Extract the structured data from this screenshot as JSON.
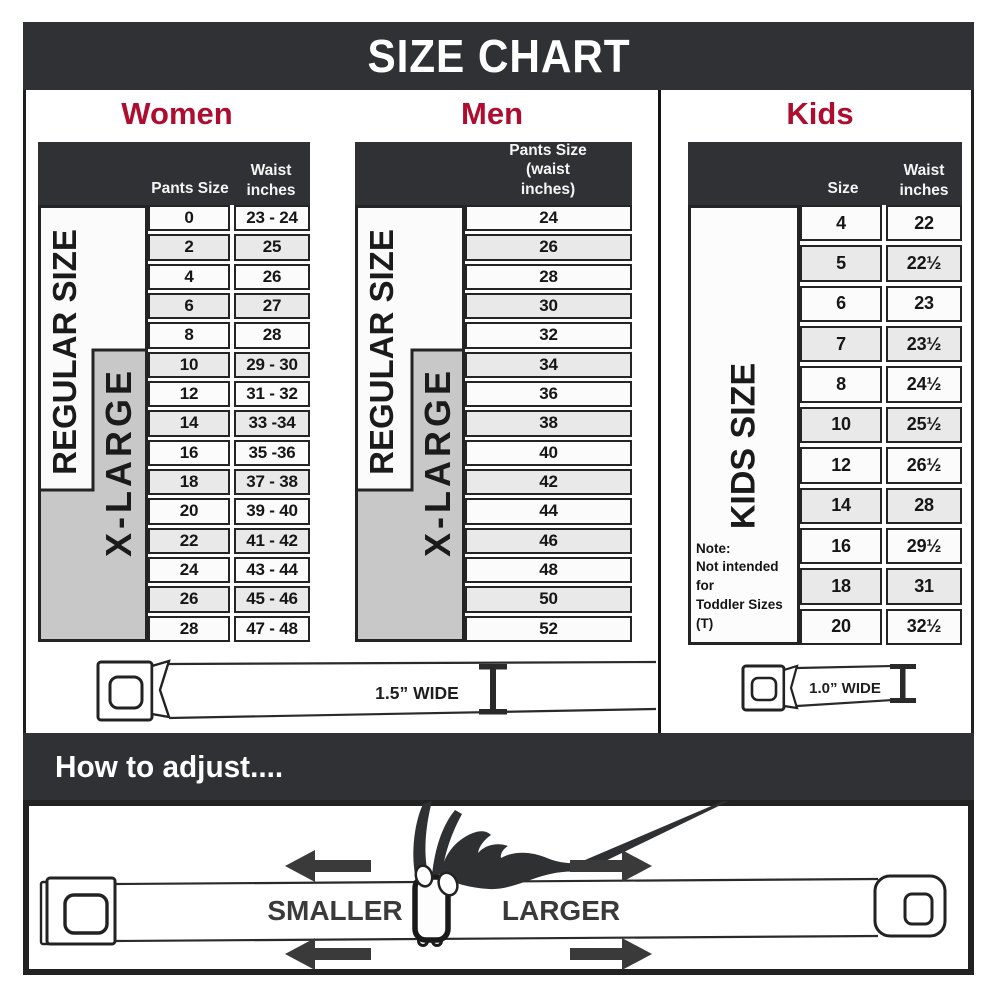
{
  "title": "SIZE CHART",
  "sections": {
    "women": {
      "label": "Women",
      "col1_header": "Pants Size",
      "col2_header": "Waist\ninches",
      "regular_label": "REGULAR SIZE",
      "xlarge_label": "X-LARGE",
      "rows": [
        [
          "0",
          "23 - 24"
        ],
        [
          "2",
          "25"
        ],
        [
          "4",
          "26"
        ],
        [
          "6",
          "27"
        ],
        [
          "8",
          "28"
        ],
        [
          "10",
          "29 - 30"
        ],
        [
          "12",
          "31 - 32"
        ],
        [
          "14",
          "33 -34"
        ],
        [
          "16",
          "35 -36"
        ],
        [
          "18",
          "37 - 38"
        ],
        [
          "20",
          "39 - 40"
        ],
        [
          "22",
          "41 - 42"
        ],
        [
          "24",
          "43 - 44"
        ],
        [
          "26",
          "45 - 46"
        ],
        [
          "28",
          "47 - 48"
        ]
      ]
    },
    "men": {
      "label": "Men",
      "header": "Pants Size\n(waist inches)",
      "regular_label": "REGULAR SIZE",
      "xlarge_label": "X-LARGE",
      "rows": [
        "24",
        "26",
        "28",
        "30",
        "32",
        "34",
        "36",
        "38",
        "40",
        "42",
        "44",
        "46",
        "48",
        "50",
        "52"
      ]
    },
    "kids": {
      "label": "Kids",
      "col1_header": "Size",
      "col2_header": "Waist\ninches",
      "size_label": "KIDS SIZE",
      "note_lines": [
        "Note:",
        "Not intended for",
        "Toddler Sizes (T)"
      ],
      "rows": [
        [
          "4",
          "22"
        ],
        [
          "5",
          "22½"
        ],
        [
          "6",
          "23"
        ],
        [
          "7",
          "23½"
        ],
        [
          "8",
          "24½"
        ],
        [
          "10",
          "25½"
        ],
        [
          "12",
          "26½"
        ],
        [
          "14",
          "28"
        ],
        [
          "16",
          "29½"
        ],
        [
          "18",
          "31"
        ],
        [
          "20",
          "32½"
        ]
      ]
    }
  },
  "belts": {
    "adult_width_label": "1.5” WIDE",
    "kids_width_label": "1.0” WIDE"
  },
  "adjust": {
    "title": "How to adjust....",
    "smaller_label": "SMALLER",
    "larger_label": "LARGER"
  },
  "colors": {
    "dark": "#303134",
    "red": "#ae0d2f",
    "row_light": "#fbfbfb",
    "row_shaded": "#e9e9e9",
    "xlarge_gray": "#c8c8c8",
    "border_black": "#242424"
  }
}
